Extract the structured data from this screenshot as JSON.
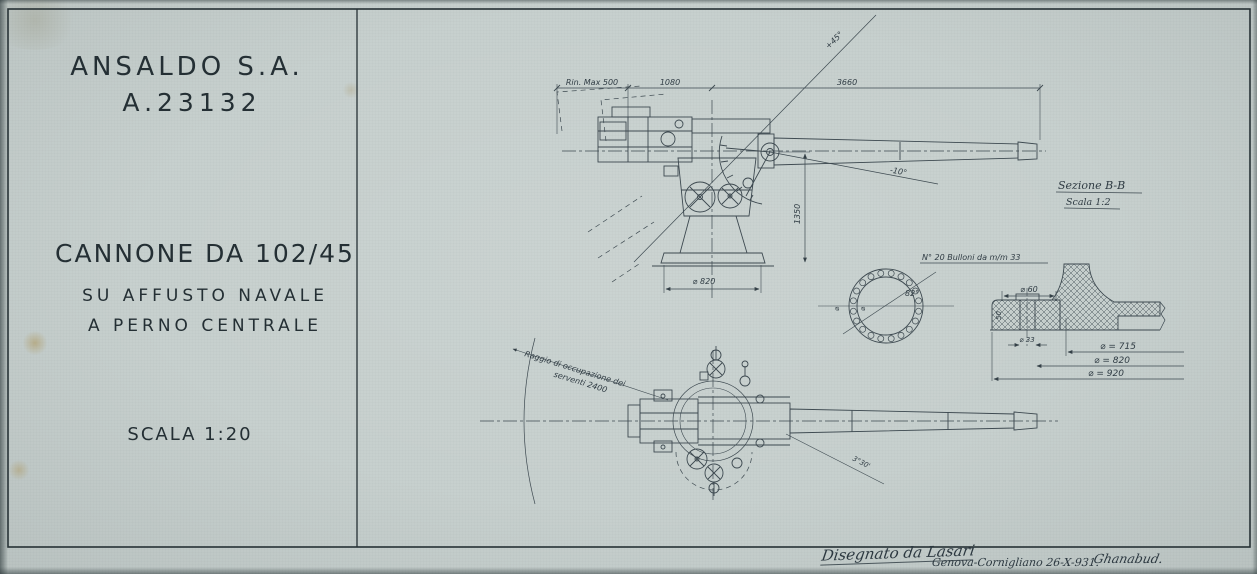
{
  "colors": {
    "paper": "#c7d0ce",
    "ink": "#344047",
    "frame": "#263135"
  },
  "title_block": {
    "company": "ANSALDO S.A.",
    "drawing_number": "A.23132",
    "gun_title": "CANNONE DA 102/45",
    "subtitle_line1": "SU AFFUSTO NAVALE",
    "subtitle_line2": "A PERNO CENTRALE",
    "scale": "SCALA 1:20"
  },
  "elevation_view": {
    "dim_recoil_max": "Rin. Max 500",
    "dim_breech_to_axis": "1080",
    "dim_axis_to_muzzle": "3660",
    "dim_axis_height": "1350",
    "dim_base_diameter": "⌀ 820",
    "max_elevation": "+45°",
    "max_depression": "-10°"
  },
  "base_plan": {
    "bolt_note": "N° 20 Bulloni da m/m 33",
    "bolt_angle": "82°",
    "dia_mark_1": "⌀",
    "dia_mark_2": "⌀"
  },
  "section_detail": {
    "title": "Sezione B-B",
    "scale": "Scala 1:2",
    "dim_seat": "⌀ 60",
    "dim_bolt_hole": "⌀ 33",
    "dim_inner": "⌀ = 715",
    "dim_bolt_circle": "⌀ = 820",
    "dim_outer": "⌀ = 920",
    "dim_thickness": "50"
  },
  "plan_view": {
    "crew_radius_line1": "Raggio di occupazione dei",
    "crew_radius_line2": "serventi 2400",
    "train_angle": "3°30'"
  },
  "footer": {
    "drawn_by": "Disegnato da Lasari",
    "place_date": "Genova-Cornigliano 26-X-931.",
    "signature": "Ghanabud."
  }
}
